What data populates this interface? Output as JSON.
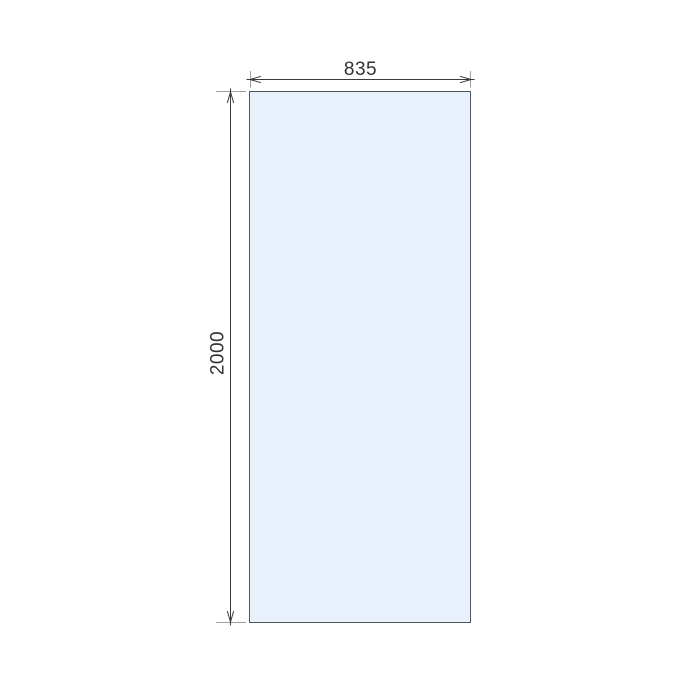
{
  "drawing": {
    "panel": {
      "width_label": "835",
      "height_label": "2000"
    },
    "colors": {
      "background": "#ffffff",
      "glass_fill": "#e8f1fb",
      "glass_border": "#4e5760",
      "dimension_line": "#3a3a3a",
      "extension_line": "#9e9e9e",
      "label_text": "#333333"
    }
  }
}
